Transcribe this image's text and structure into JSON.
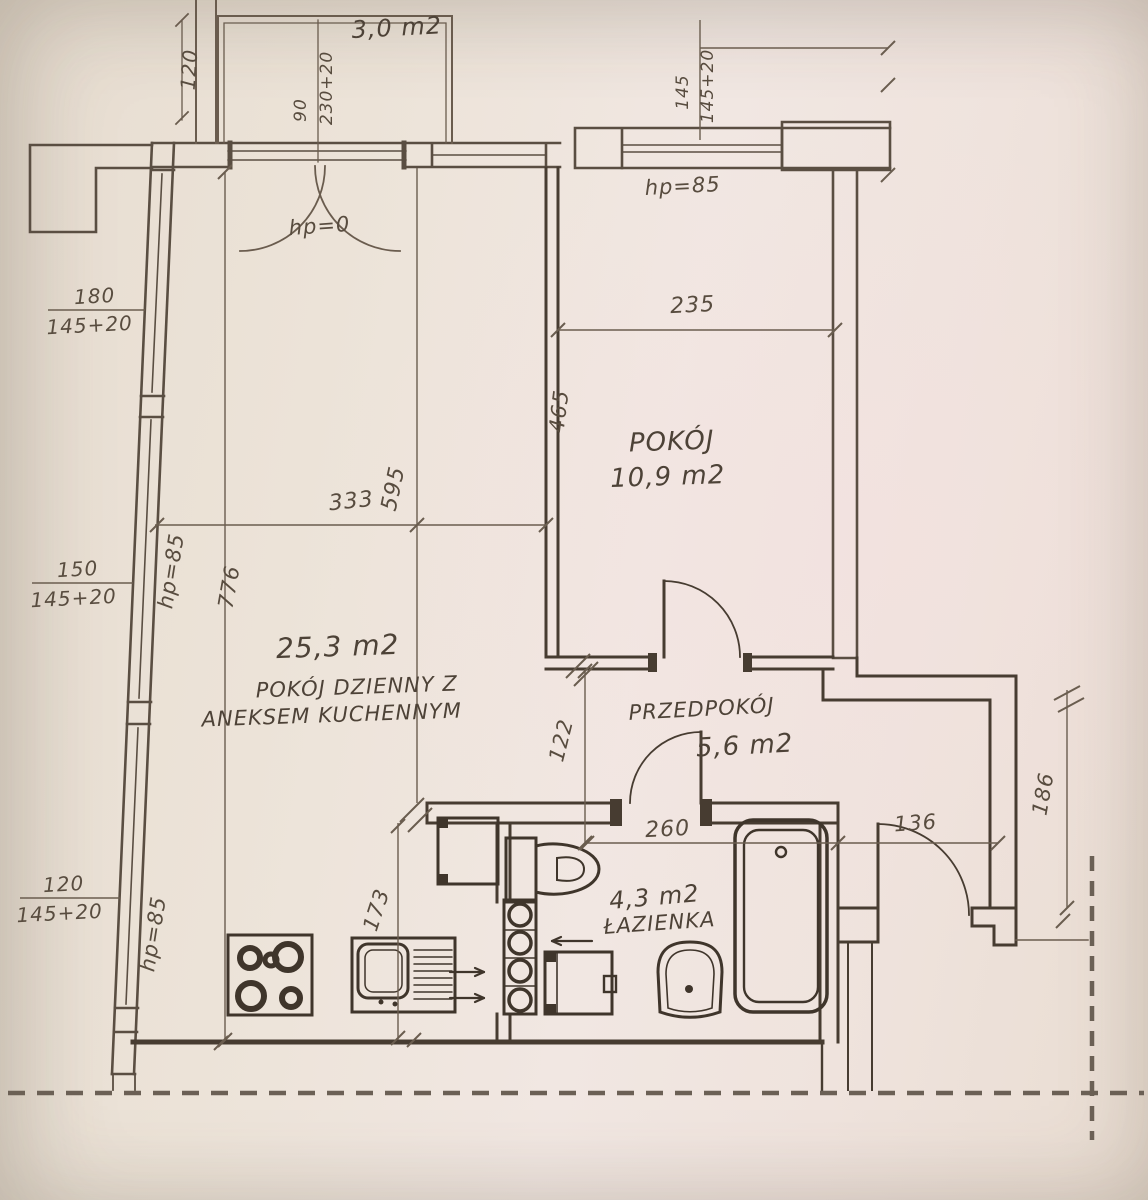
{
  "labels": {
    "balcony_area": "3,0 m2",
    "balcony_depth": "120",
    "door_w": "90",
    "door_h": "230+20",
    "hp0": "hp=0",
    "win_r_w": "145",
    "win_r_h": "145+20",
    "hp85_right": "hp=85",
    "win1_w": "180",
    "win1_h": "145+20",
    "hp85_mid": "hp=85",
    "win2_w": "150",
    "win2_h": "145+20",
    "win3_w": "120",
    "win3_h": "145+20",
    "hp85_low": "hp=85",
    "d235": "235",
    "d465": "465",
    "d595": "595",
    "d333": "333",
    "d776": "776",
    "d122": "122",
    "d173": "173",
    "d260": "260",
    "d136": "136",
    "d186": "186",
    "pokoj_name": "POKÓJ",
    "pokoj_area": "10,9 m2",
    "living_area": "25,3 m2",
    "living_name1": "POKÓJ DZIENNY Z",
    "living_name2": "ANEKSEM KUCHENNYM",
    "hall_name": "PRZEDPOKÓJ",
    "hall_area": "5,6 m2",
    "bath_area": "4,3 m2",
    "bath_name": "ŁAZIENKA"
  }
}
